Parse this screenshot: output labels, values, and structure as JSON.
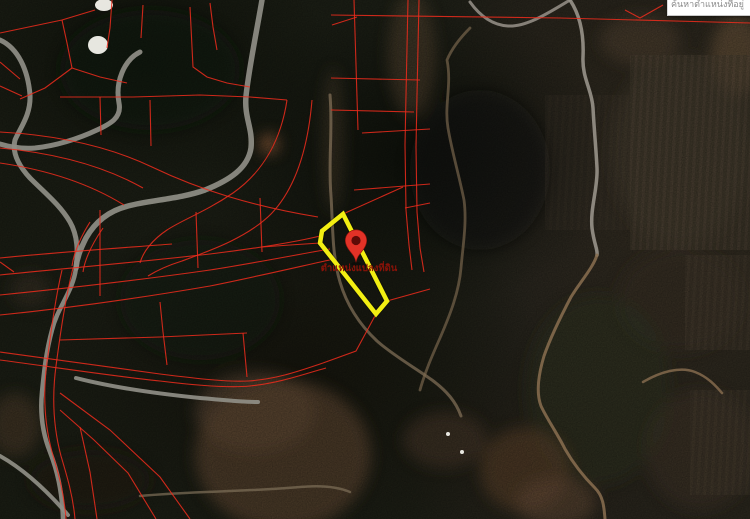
{
  "search_box": {
    "text": "ค้นหาตำแหน่งที่อยู่"
  },
  "map": {
    "marker_label": "ตำแหน่งแปลงที่ดิน",
    "colors": {
      "parcel_highlight": "#f2ee12",
      "boundary": "#ee2b1c",
      "pin": "#e23227",
      "pin_inner": "#5f0b07",
      "road": "#8f8e86",
      "trail_gray": "#98928a",
      "trail_dirt": "#8a6e50",
      "label": "#8a1208",
      "building": "#f3f2ec"
    },
    "parcel": {
      "points": "343,214 322,231 320,243 376,314 387,301"
    },
    "pin": {
      "cx": 356,
      "head_cy": 240.5,
      "tip_y": 262.4,
      "label_x": 359,
      "label_y": 271
    },
    "roads": [
      {
        "d": "M0,40 C18,48 28,70 30,95 C31,115 20,128 15,140 C12,152 18,165 30,178 C45,193 60,205 70,222 C78,236 78,252 76,268",
        "w": 5
      },
      {
        "d": "M76,268 C73,292 58,306 52,330 C46,352 44,372 42,392 C40,412 42,432 50,452 C57,470 62,490 63,519",
        "w": 4.5
      },
      {
        "d": "M140,52 C124,60 115,82 119,103 C122,118 110,124 97,130 C78,139 55,146 35,148 C22,149 10,147 0,144",
        "w": 5
      },
      {
        "d": "M262,0 C256,35 249,68 246,96 C244,118 253,128 251,148 C248,168 230,180 205,190 C180,199 150,200 128,206 C108,211 95,222 86,238 C80,250 77,258 76,268",
        "w": 5.5
      },
      {
        "d": "M76,378 C115,388 160,394 200,398 C224,400 242,402 258,402",
        "w": 4
      },
      {
        "d": "M0,456 C25,470 48,492 68,515",
        "w": 4
      }
    ],
    "trails": [
      {
        "d": "M570,0 C580,15 584,35 583,57 C582,78 592,90 593,108 C594,128 596,148 597,168 C598,188 590,208 592,228 C594,244 598,250 597,255",
        "w": 3.5,
        "c": "#98928a",
        "o": 0.9
      },
      {
        "d": "M470,2 C480,16 492,25 508,26 C527,27 550,12 570,0",
        "w": 3,
        "c": "#98928a",
        "o": 0.85
      },
      {
        "d": "M597,255 C593,268 580,282 571,297 C561,316 551,336 544,356 C538,376 536,393 541,406 C547,419 557,433 565,449 C573,463 583,476 595,488 C603,496 604,506 605,519",
        "w": 3,
        "c": "#8a6e50",
        "o": 0.85
      },
      {
        "d": "M330,95 C333,130 328,162 331,196 C333,228 332,255 340,282 C347,306 360,325 377,341 C394,356 414,367 432,380 C447,391 456,402 461,416",
        "w": 3,
        "c": "#85725a",
        "o": 0.7
      },
      {
        "d": "M470,28 C460,38 452,48 447,60 C452,85 444,105 448,128 C452,152 459,175 464,200 C467,222 463,245 461,268 C459,292 450,315 440,338 C432,356 425,372 420,390",
        "w": 2.8,
        "c": "#7e6a50",
        "o": 0.65
      },
      {
        "d": "M643,382 C660,372 680,366 695,372 C708,377 716,386 722,393",
        "w": 2.5,
        "c": "#8a6e50",
        "o": 0.8
      },
      {
        "d": "M140,496 C190,491 245,492 300,487 C322,485 338,487 350,492",
        "w": 2.5,
        "c": "#7e6f58",
        "o": 0.7
      }
    ],
    "boundaries": [
      "M331,15 L560,18 L750,23",
      "M625,10 L640,18 L663,5",
      "M354,0 L358,130",
      "M408,0 L406,95 L405,145 L406,210 L409,245 L412,270",
      "M419,0 L417,95 L416,147 L417,212 L420,248 L424,272",
      "M331,78 L420,80",
      "M331,110 L414,112",
      "M362,133 L430,129",
      "M354,190 L430,184",
      "M405,208 L430,203",
      "M332,25 L357,17",
      "M343,214 L403,187",
      "M387,301 L430,289",
      "M376,314 L356,351 L323,363",
      "M0,352 C60,360 120,369 160,374 C200,379 228,382 248,381 C278,379 302,370 323,363",
      "M0,360 C60,368 120,377 160,381 C200,386 230,388 250,386 C280,383 304,374 326,368",
      "M320,243 L290,245 L262,247",
      "M287,100 C281,140 263,172 233,193 C205,212 182,220 167,230 C152,240 143,252 140,263",
      "M312,100 C308,148 296,188 271,214 C248,237 212,250 182,261 C166,266 156,271 148,276",
      "M0,132 C55,135 108,146 152,167 C200,190 252,206 318,217",
      "M0,148 C55,153 104,166 143,188",
      "M0,163 C48,170 90,184 124,205",
      "M60,97 L133,97 L200,95 L250,97 L287,100",
      "M0,33 L62,20 L95,10",
      "M62,20 L67,43 L72,68",
      "M72,68 L100,77 L127,83",
      "M72,68 L45,88 L20,99",
      "M112,0 L110,28 L107,48",
      "M190,7 L193,67 L207,77 L227,83 L250,87",
      "M210,3 L213,27 L217,50",
      "M143,5 L141,38",
      "M100,97 L101,135",
      "M150,100 L151,146",
      "M0,275 C70,268 140,262 210,254 C252,249 296,242 320,236",
      "M0,295 C70,288 140,280 210,270 C255,263 300,254 330,249",
      "M0,315 C70,308 140,298 210,286 C255,277 302,266 334,259",
      "M0,258 C60,252 120,248 172,244",
      "M100,210 L100,296",
      "M196,212 L198,268",
      "M260,198 L262,252",
      "M90,222 C80,238 74,252 72,266",
      "M103,228 C92,244 85,258 83,272",
      "M0,62 L20,79",
      "M0,86 L22,96",
      "M60,340 L160,337 L247,333",
      "M160,302 L163,332 L167,365",
      "M243,333 L247,377",
      "M60,393 L110,430 L160,477 L190,519",
      "M60,410 L94,440 L128,473 L156,519",
      "M80,427 L90,472 L97,519",
      "M62,270 C55,300 51,332 47,362 C43,392 44,422 52,452 C58,472 64,492 66,519",
      "M73,268 C65,300 60,336 56,366 C52,396 53,426 61,456 C67,476 73,496 75,519",
      "M0,262 L14,272"
    ],
    "terrain": [
      {
        "cx": 283,
        "cy": 455,
        "rx": 88,
        "ry": 75,
        "f": "#5a432e",
        "o": 0.8
      },
      {
        "cx": 255,
        "cy": 412,
        "rx": 60,
        "ry": 40,
        "f": "#67503a",
        "o": 0.6
      },
      {
        "cx": 445,
        "cy": 440,
        "rx": 42,
        "ry": 28,
        "f": "#54402e",
        "o": 0.55
      },
      {
        "cx": 412,
        "cy": 55,
        "rx": 24,
        "ry": 62,
        "f": "#6b543c",
        "o": 0.45
      },
      {
        "cx": 333,
        "cy": 140,
        "rx": 11,
        "ry": 72,
        "f": "#6b543c",
        "o": 0.35
      },
      {
        "cx": 269,
        "cy": 144,
        "rx": 10,
        "ry": 10,
        "f": "#8a5a38",
        "o": 0.9
      },
      {
        "cx": 737,
        "cy": 55,
        "rx": 26,
        "ry": 40,
        "f": "#7d6145",
        "o": 0.55
      },
      {
        "cx": 15,
        "cy": 425,
        "rx": 26,
        "ry": 32,
        "f": "#5a432e",
        "o": 0.55
      },
      {
        "cx": 680,
        "cy": 300,
        "rx": 62,
        "ry": 52,
        "f": "#3e3429",
        "o": 0.6
      },
      {
        "cx": 30,
        "cy": 290,
        "rx": 20,
        "ry": 18,
        "f": "#4a3a2c",
        "o": 0.45
      },
      {
        "cx": 598,
        "cy": 390,
        "rx": 72,
        "ry": 95,
        "f": "#323a26",
        "o": 0.5
      },
      {
        "cx": 525,
        "cy": 470,
        "rx": 45,
        "ry": 42,
        "f": "#66492f",
        "o": 0.6
      },
      {
        "cx": 556,
        "cy": 502,
        "rx": 40,
        "ry": 25,
        "f": "#70523a",
        "o": 0.55
      },
      {
        "cx": 680,
        "cy": 150,
        "rx": 70,
        "ry": 95,
        "f": "#4c4033",
        "o": 0.5
      },
      {
        "cx": 700,
        "cy": 450,
        "rx": 55,
        "ry": 60,
        "f": "#4a3c2d",
        "o": 0.45
      },
      {
        "cx": 150,
        "cy": 70,
        "rx": 90,
        "ry": 60,
        "f": "#161a10",
        "o": 0.6
      },
      {
        "cx": 480,
        "cy": 170,
        "rx": 70,
        "ry": 80,
        "f": "#141710",
        "o": 0.55
      },
      {
        "cx": 200,
        "cy": 300,
        "rx": 80,
        "ry": 60,
        "f": "#1a1d13",
        "o": 0.5
      },
      {
        "cx": 640,
        "cy": 40,
        "rx": 40,
        "ry": 25,
        "f": "#5e4b36",
        "o": 0.5
      },
      {
        "cx": 90,
        "cy": 480,
        "rx": 60,
        "ry": 30,
        "f": "#242017",
        "o": 0.6
      }
    ],
    "fields": [
      {
        "x": 630,
        "y": 55,
        "w": 120,
        "h": 195,
        "o": 0.55
      },
      {
        "x": 685,
        "y": 255,
        "w": 65,
        "h": 95,
        "o": 0.4
      },
      {
        "x": 690,
        "y": 390,
        "w": 60,
        "h": 105,
        "o": 0.35
      },
      {
        "x": 545,
        "y": 95,
        "w": 85,
        "h": 135,
        "o": 0.22
      }
    ],
    "buildings": [
      {
        "cx": 104,
        "cy": 5,
        "rx": 9,
        "ry": 6
      },
      {
        "cx": 98,
        "cy": 45,
        "rx": 10,
        "ry": 9
      },
      {
        "cx": 448,
        "cy": 434,
        "rx": 2,
        "ry": 2
      },
      {
        "cx": 462,
        "cy": 452,
        "rx": 2,
        "ry": 2
      }
    ]
  }
}
